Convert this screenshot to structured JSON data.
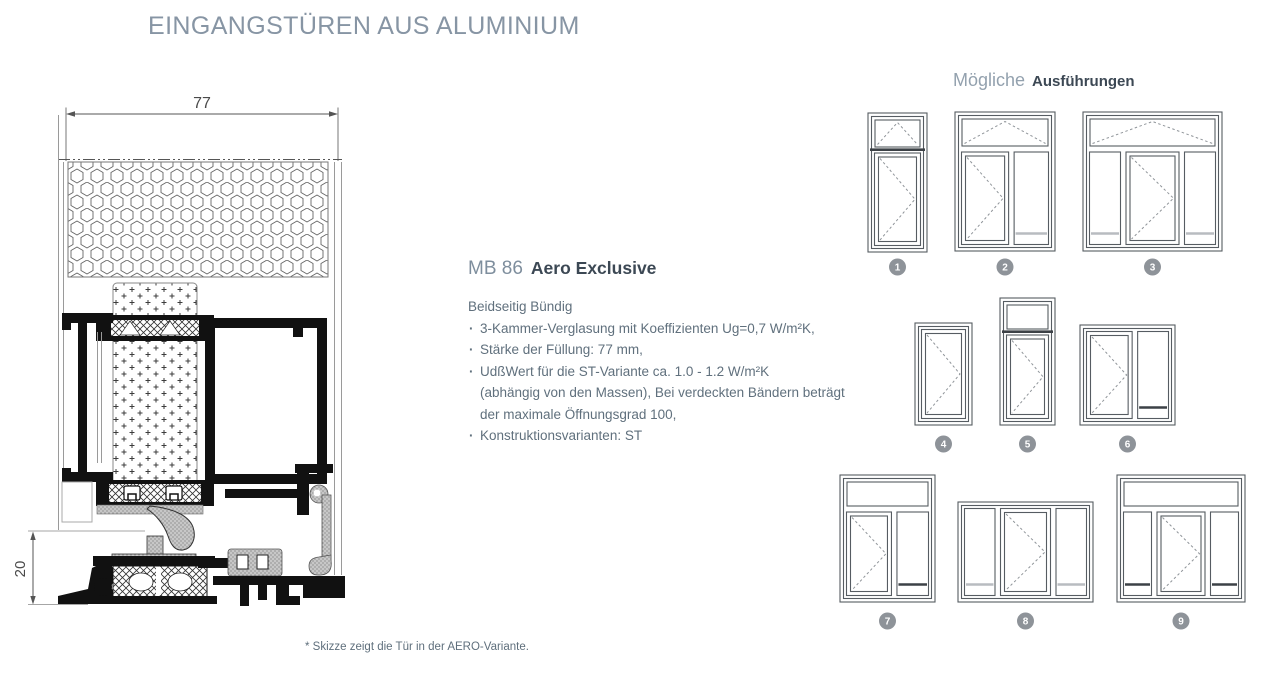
{
  "page": {
    "title": "EINGANGSTÜREN AUS ALUMINIUM",
    "footnote": "* Skizze zeigt die Tür in der AERO-Variante."
  },
  "drawing": {
    "dim_width": "77",
    "dim_height": "20"
  },
  "product": {
    "code": "MB 86",
    "name": "Aero Exclusive",
    "subtitle": "Beidseitig Bündig",
    "features": [
      "3-Kammer-Verglasung mit Koeffizienten Ug=0,7 W/m²K,",
      "Stärke der Füllung: 77 mm,",
      "UdßWert für die ST-Variante  ca. 1.0 - 1.2 W/m²K\n(abhängig von den Massen), Bei verdeckten Bändern beträgt\nder maximale Öffnungsgrad 100,",
      "Konstruktionsvarianten: ST"
    ]
  },
  "variants_panel": {
    "heading_light": "Mögliche",
    "heading_bold": "Ausführungen",
    "doors": [
      {
        "num": "1",
        "x": 868,
        "y": 113,
        "w": 59,
        "h": 139,
        "badge_y": 267,
        "transom": {
          "type": "tilt",
          "h": 30,
          "sep": true
        },
        "cols": [
          {
            "t": "leaf",
            "f": 1
          }
        ]
      },
      {
        "num": "2",
        "x": 955,
        "y": 112,
        "w": 100,
        "h": 139,
        "badge_y": 267,
        "transom": {
          "type": "tilt",
          "h": 30
        },
        "cols": [
          {
            "t": "leaf",
            "f": 1.35
          },
          {
            "t": "panel",
            "f": 1,
            "marker": "light"
          }
        ]
      },
      {
        "num": "3",
        "x": 1083,
        "y": 112,
        "w": 139,
        "h": 139,
        "badge_y": 267,
        "transom": {
          "type": "tilt",
          "h": 30
        },
        "cols": [
          {
            "t": "panel",
            "f": 0.78,
            "marker": "light"
          },
          {
            "t": "leaf",
            "f": 1.3
          },
          {
            "t": "panel",
            "f": 0.78,
            "marker": "light"
          }
        ]
      },
      {
        "num": "4",
        "x": 915,
        "y": 323,
        "w": 57,
        "h": 102,
        "badge_y": 444,
        "cols": [
          {
            "t": "leaf",
            "f": 1
          }
        ]
      },
      {
        "num": "5",
        "x": 1000,
        "y": 298,
        "w": 55,
        "h": 127,
        "badge_y": 444,
        "transom": {
          "type": "plain",
          "h": 27,
          "sep": true
        },
        "cols": [
          {
            "t": "leaf",
            "f": 1
          }
        ]
      },
      {
        "num": "6",
        "x": 1080,
        "y": 325,
        "w": 95,
        "h": 100,
        "badge_y": 444,
        "cols": [
          {
            "t": "leaf",
            "f": 1.45
          },
          {
            "t": "panel",
            "f": 1,
            "marker": "dark"
          }
        ]
      },
      {
        "num": "7",
        "x": 840,
        "y": 475,
        "w": 95,
        "h": 127,
        "badge_y": 621,
        "transom": {
          "type": "plain",
          "h": 27
        },
        "cols": [
          {
            "t": "leaf",
            "f": 1.4
          },
          {
            "t": "panel",
            "f": 1,
            "marker": "dark"
          }
        ]
      },
      {
        "num": "8",
        "x": 958,
        "y": 502,
        "w": 135,
        "h": 100,
        "badge_y": 621,
        "cols": [
          {
            "t": "panel",
            "f": 0.75,
            "marker": "light"
          },
          {
            "t": "leaf",
            "f": 1.2
          },
          {
            "t": "panel",
            "f": 0.75,
            "marker": "light"
          }
        ]
      },
      {
        "num": "9",
        "x": 1117,
        "y": 475,
        "w": 128,
        "h": 127,
        "badge_y": 621,
        "transom": {
          "type": "plain",
          "h": 27
        },
        "cols": [
          {
            "t": "panel",
            "f": 0.75,
            "marker": "dark"
          },
          {
            "t": "leaf",
            "f": 1.25
          },
          {
            "t": "panel",
            "f": 0.75,
            "marker": "dark"
          }
        ]
      }
    ]
  },
  "colors": {
    "badge": "#8e9399",
    "door_stroke": "#565c62",
    "dash_stroke": "#8f9499",
    "marker_dark": "#3c4146",
    "marker_light": "#b8bcc0"
  }
}
